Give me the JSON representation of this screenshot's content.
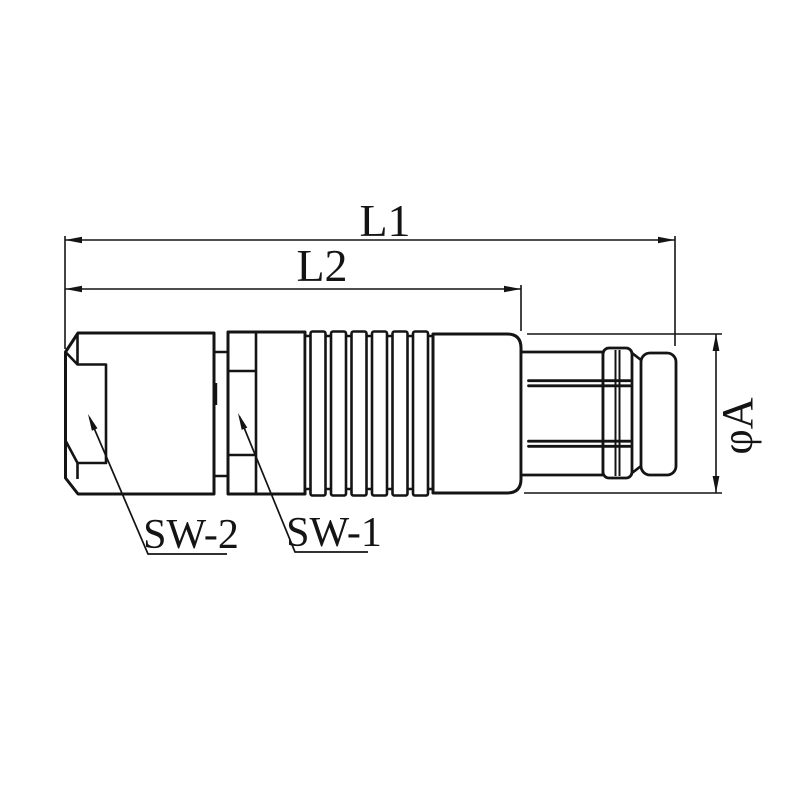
{
  "canvas": {
    "background": "#ffffff",
    "line_color": "#141414"
  },
  "dimensions": {
    "l1": {
      "label": "L1"
    },
    "l2": {
      "label": "L2"
    },
    "diameter": {
      "label": "φA"
    }
  },
  "callouts": {
    "sw2": {
      "label": "SW-2"
    },
    "sw1": {
      "label": "SW-1"
    }
  }
}
